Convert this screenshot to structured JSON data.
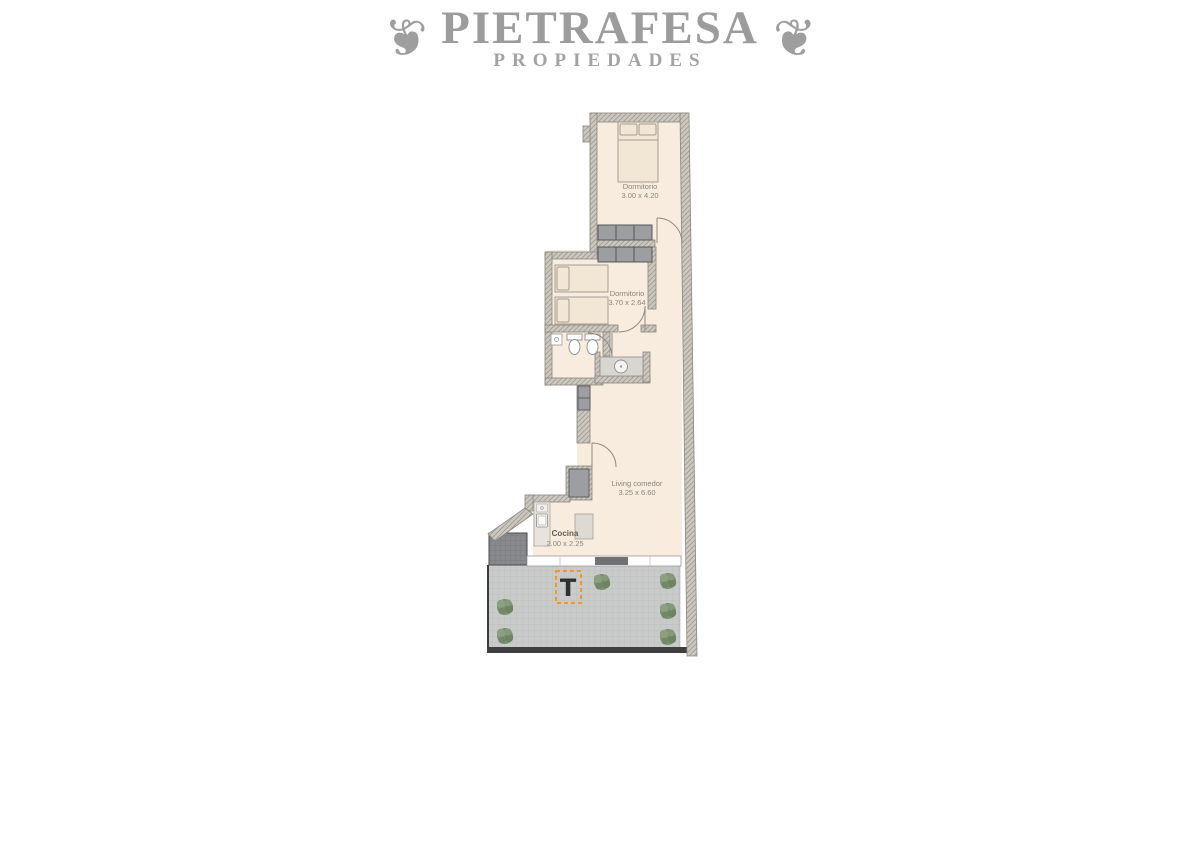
{
  "brand": {
    "name": "PIETRAFESA",
    "tagline": "PROPIEDADES",
    "ornament": "❦"
  },
  "floorplan": {
    "rooms": [
      {
        "name": "Dormitorio",
        "dims": "3.00 x 4.20"
      },
      {
        "name": "Dormitorio",
        "dims": "3.70 x 2.64"
      },
      {
        "name": "Living comedor",
        "dims": "3.25 x 6.60"
      },
      {
        "name": "Cocina",
        "dims": "2.00 x 2.25"
      }
    ],
    "terrace": {
      "marker": "T"
    },
    "colors": {
      "floor": "#f8ecdf",
      "wall": "#ccc8c0",
      "terrace_tile": "#c9cbca",
      "planter_tile": "#87898c",
      "marker_accent": "#f0962e",
      "vegetation": "#7c9170",
      "furniture_gray": "#9c9ea1",
      "logo_gray": "#9c9c9c"
    }
  }
}
